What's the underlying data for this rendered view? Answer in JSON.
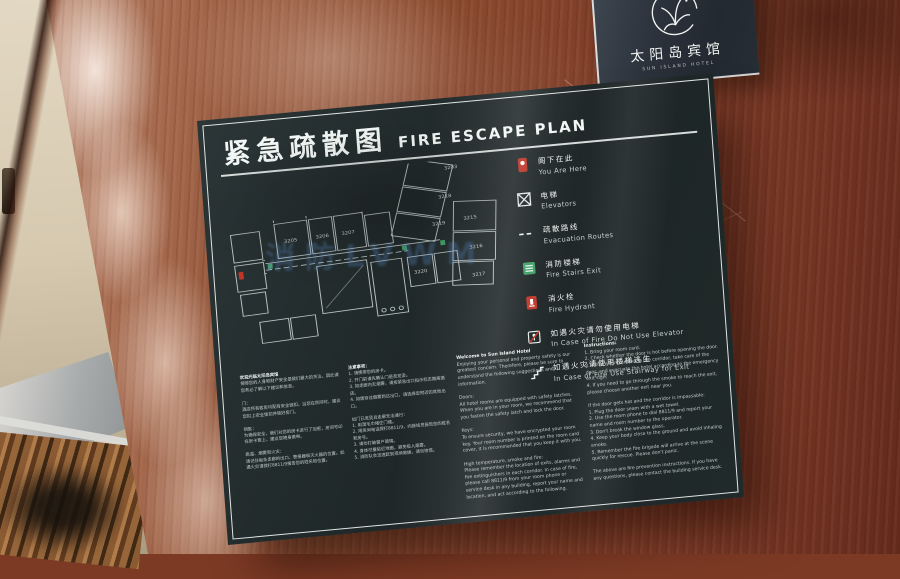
{
  "logo_panel": {
    "hotel_name_cn": "太阳岛宾馆",
    "hotel_name_en": "SUN ISLAND HOTEL"
  },
  "sign": {
    "title_cn": "紧急疏散图",
    "title_en": "FIRE ESCAPE PLAN",
    "watermark": "消防LVWM",
    "legend": [
      {
        "icon": "you-are-here-icon",
        "cn": "阁下在此",
        "en": "You Are Here"
      },
      {
        "icon": "elevator-icon",
        "cn": "电梯",
        "en": "Elevators"
      },
      {
        "icon": "route-dash-icon",
        "cn": "疏散路线",
        "en": "Evacuation Routes"
      },
      {
        "icon": "fire-stairs-icon",
        "cn": "消防楼梯",
        "en": "Fire Stairs Exit"
      },
      {
        "icon": "fire-hydrant-icon",
        "cn": "消火栓",
        "en": "Fire Hydrant"
      },
      {
        "icon": "no-elevator-icon",
        "cn": "如遇火灾请勿使用电梯",
        "en": "In Case of Fire Do Not Use Elevator"
      },
      {
        "icon": "stairway-exit-icon",
        "cn": "如遇火灾请使用楼梯逃生",
        "en": "In Case of Fire Use Stairway for Exit"
      }
    ],
    "floor_plan": {
      "rooms": [
        "3203",
        "3218",
        "3219",
        "3215",
        "3216",
        "3217",
        "3205",
        "3206",
        "3207",
        "3220"
      ]
    },
    "columns": {
      "cn_welcome": "欢迎光临太阳岛宾馆\n保障您的人身和财产安全是我们最大的关注，因此请您务必了解以下建议和信息。\n\n门：\n酒店所有客房均配有安全锁扣，当您在房间时，建议您扣上安全锁扣并锁好房门。\n\n钥匙：\n为确保安全，我们对您的房卡进行了加密，房间号印在房卡套上，建议您随身携带。\n\n高温、烟雾和火灾：\n请记住每条走廊的出口、警报器和灭火器的位置。如遇火灾请拨打8811/9报告您的姓名和位置。",
      "cn_instructions": "注意事项：\n1. 请携带您的房卡。\n2. 开门前请先确认门是否发烫。\n3. 如走廊内无烟雾，请按紧急出口指示标志撤离酒店。\n4. 如需穿过烟雾到达出口，请选择您附近的其他出口。\n\n如门已发烫且走廊无法通行：\n1. 用湿毛巾堵住门缝。\n2. 用房间电话拨打8811/9，向接线员报告您的姓名和房号。\n3. 请勿打破窗户玻璃。\n4. 身体尽量贴近地面，避免吸入烟雾。\n5. 消防队会迅速赶到现场救援，请勿惊慌。",
      "en_welcome": "Welcome to Sun Island Hotel\nEnjoying your personal and property safety is our greatest concern. Therefore, please be sure to understand the following suggestions and information.\n\nDoors:\nAll hotel rooms are equipped with safety latches. When you are in your room, we recommend that you fasten the safety latch and lock the door.\n\nKeys:\nTo ensure security, we have encrypted your room key. Your room number is printed on the room card cover, it is recommended that you keep it with you.\n\nHigh temperature, smoke and fire:\nPlease remember the location of exits, alarms and fire extinguishers in each corridor. In case of fire, please call 8811/9 from your room phone or service desk in any building, report your name and location, and act according to the following.",
      "en_instructions": "Instructions:\n1. Bring your room card.\n2. Check whether the door is hot before opening the door.\n3. If there is no smoke in the corridor, take care of the door, and evacuate the hotel according to the emergency exit sign.\n4. If you need to go through the smoke to reach the exit, please choose another exit near you.\n\nIf the door gets hot and the corridor is impassable:\n1. Plug the door seam with a wet towel.\n2. Use the room phone to dial 8811/9 and report your name and room number to the operator.\n3. Don't break the window glass.\n4. Keep your body close to the ground and avoid inhaling smoke.\n5. Remember the fire brigade will arrive at the scene quickly for rescue. Please don't panic.\n\nThe above are fire prevention instructions. If you have any questions, please contact the building service desk."
    }
  },
  "colors": {
    "accent_red": "#c13527",
    "stairs_green": "#3e9e66",
    "sign_background": "#222b2b",
    "wood": "#8a4a2f",
    "watermark_blue": "#5f96dc"
  }
}
